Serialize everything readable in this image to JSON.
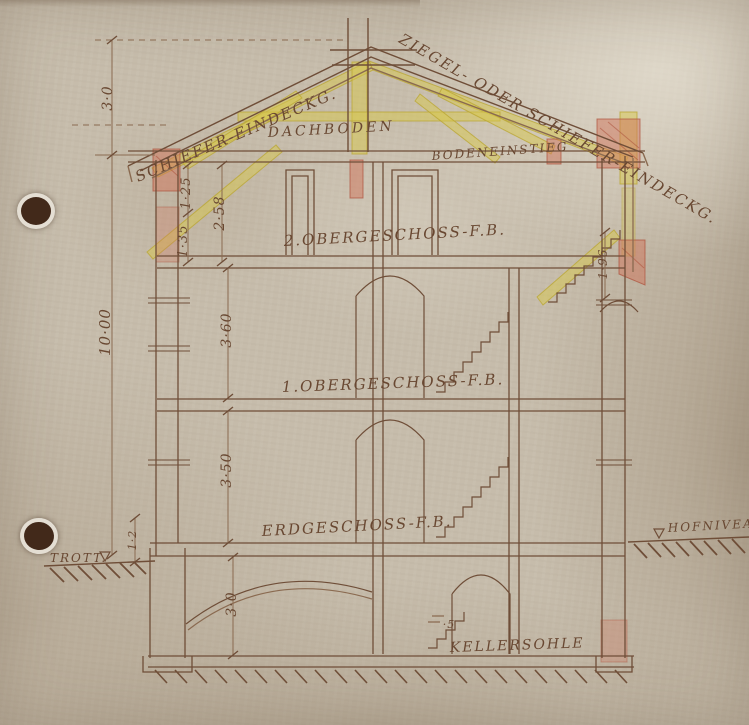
{
  "drawing": {
    "kind": "building-cross-section",
    "labels": {
      "roof_left": "SCHIEFER-EINDECKG.",
      "roof_right": "ZIEGEL- ODER SCHIEFER-EINDECKG.",
      "attic": "DACHBODEN",
      "attic_access": "BODENEINSTIEG",
      "floor2": "2.OBERGESCHOSS-F.B.",
      "floor1": "1.OBERGESCHOSS-F.B.",
      "ground_floor": "ERDGESCHOSS-F.B.",
      "cellar": "KELLERSOHLE",
      "sidewalk": "TROTT.",
      "yard_level": "HOFNIVEAU"
    },
    "dimensions": {
      "roof_height": "3·0",
      "attic_seg_upper": "1·25",
      "attic_seg_lower": "1·35",
      "attic_total": "2·58",
      "overall_height": "10·00",
      "floor2_height": "3·60",
      "floor1_height": "3·50",
      "cellar_height": "3·0",
      "sidewalk_offset": "1·2",
      "stair_height": "1·96",
      "cellar_step": "·5"
    },
    "colors": {
      "ink": "#6f4e38",
      "highlight_yellow": "#d8c74c",
      "wall_red": "#c97a5d",
      "paper": "#c6bcab"
    }
  }
}
